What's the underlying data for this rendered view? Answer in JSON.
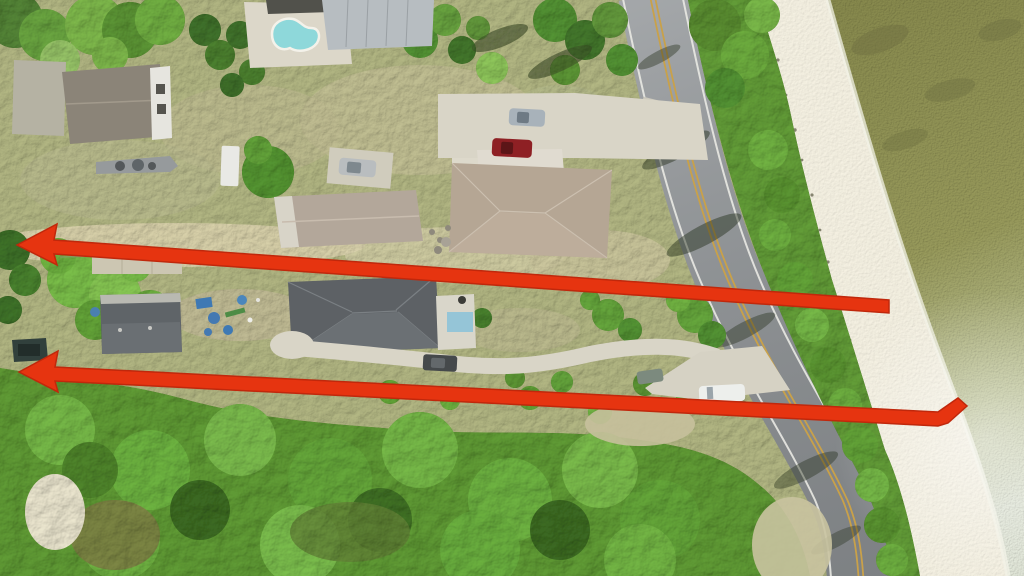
{
  "image": {
    "type": "aerial-drone-photograph",
    "description": "Overhead aerial photo of a coastal residential strip: cleared lots and houses on the left, a two-lane road running diagonally on the right, a narrow tree line, white-sand beach and sunlit bay water in the upper/right corner, dense forest across the bottom. Two long red annotation arrows span the image pointing left.",
    "width": 1024,
    "height": 576
  },
  "annotations": {
    "arrow_color": "#e63410",
    "arrow_edge": "#c0280c",
    "arrows": [
      {
        "name": "upper-red-arrow",
        "direction": "pointing-left",
        "tail_x": 889,
        "tail_y": 306,
        "tip_x": 18,
        "tip_y": 244
      },
      {
        "name": "lower-red-arrow",
        "direction": "pointing-left",
        "tail_x": 966,
        "tail_y": 404,
        "tip_x": 19,
        "tip_y": 372
      }
    ]
  },
  "colors": {
    "grass": "#a9ad7c",
    "scrub_sand": "#cfc8a4",
    "forest": "#5a9231",
    "east_trees": "#5d9434",
    "beach_sand": "#e9e5d7",
    "water_deep": "#7f8148",
    "water_mid": "#8f9156",
    "water_bright": "#b3b98f",
    "water_glint": "#d3d8ca",
    "road": "#8f9396",
    "road_yellow": "#c9a149",
    "road_white": "#e9e9e3",
    "concrete": "#d9d5c7",
    "subject_roof": "#5d6165",
    "west_roof": "#5f6468",
    "neighbor_roof_c": "#b3a79a",
    "neighbor_roof_d": "#b5a694",
    "garage_white_roof": "#e0dbd0",
    "barn_roof": "#8b8478",
    "barn_tower": "#e6e5df",
    "pool_house_roof": "#b7bdc1",
    "pool_water": "#8ed8da",
    "pool_deck": "#dcd7c9",
    "shoreline_foam": "#f2f2e6"
  },
  "vehicles": [
    {
      "name": "parked-silver-car",
      "color": "#b9bdbf"
    },
    {
      "name": "north-driveway-silver-car",
      "color": "#a8b2ba"
    },
    {
      "name": "north-driveway-red-car",
      "color": "#8e2024"
    },
    {
      "name": "subject-driveway-dark-car",
      "color": "#45494b"
    },
    {
      "name": "forest-edge-gray-car",
      "color": "#7c8a7e"
    },
    {
      "name": "white-suv",
      "color": "#edefec"
    },
    {
      "name": "boat-on-trailer",
      "color": "#969a9c"
    },
    {
      "name": "utility-trailer",
      "color": "#e9e9e5"
    }
  ]
}
